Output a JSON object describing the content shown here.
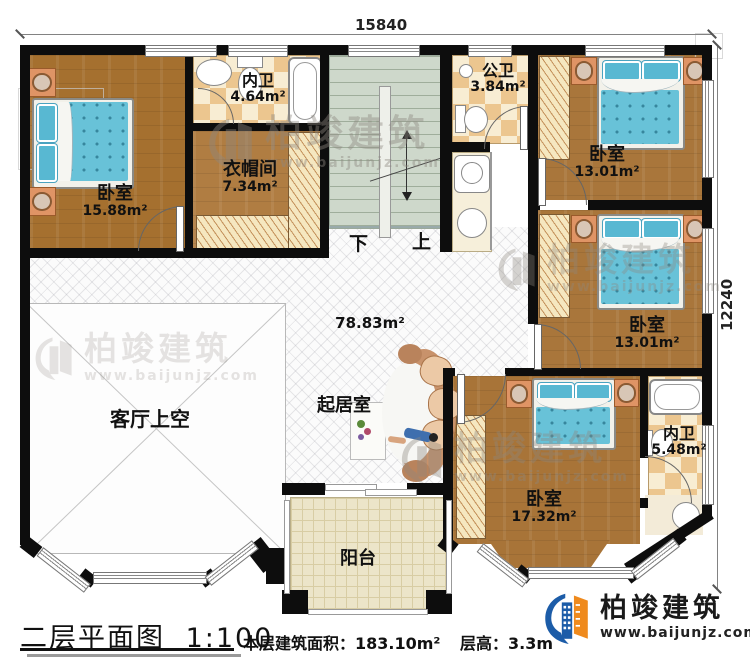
{
  "title": {
    "text": "二层平面图",
    "scale": "1:100"
  },
  "footer": {
    "area_label": "本层建筑面积：",
    "area_value": "183.10m²",
    "height_label": "层高：",
    "height_value": "3.3m"
  },
  "dimensions": {
    "top": "15840",
    "right": "12240"
  },
  "stairs": {
    "down": "下",
    "up": "上"
  },
  "brand": {
    "name": "柏竣建筑",
    "url": "www.baijunjz.com"
  },
  "rooms": [
    {
      "id": "bedroom-top-left",
      "name": "卧室",
      "area": "15.88m²"
    },
    {
      "id": "ensuite-bath-top",
      "name": "内卫",
      "area": "4.64m²"
    },
    {
      "id": "cloakroom",
      "name": "衣帽间",
      "area": "7.34m²"
    },
    {
      "id": "public-bath",
      "name": "公卫",
      "area": "3.84m²"
    },
    {
      "id": "bedroom-top-right",
      "name": "卧室",
      "area": "13.01m²"
    },
    {
      "id": "bedroom-mid-right",
      "name": "卧室",
      "area": "13.01m²"
    },
    {
      "id": "bedroom-bottom",
      "name": "卧室",
      "area": "17.32m²"
    },
    {
      "id": "ensuite-bath-bottom",
      "name": "内卫",
      "area": "5.48m²"
    },
    {
      "id": "sitting-hall",
      "name": "起居室",
      "area": "78.83m²"
    },
    {
      "id": "living-void",
      "name": "客厅上空",
      "area": ""
    },
    {
      "id": "balcony",
      "name": "阳台",
      "area": ""
    }
  ],
  "colors": {
    "wall": "#0d0d0d",
    "wood_floor": "#a9763b",
    "bed_blue": "#68c2d8",
    "bath_checker": "#ecc68f",
    "stair_green": "#ced8cb",
    "balcony_floor": "#ece5c9",
    "brand_blue": "#1c5ca8",
    "brand_orange": "#ef8a1d"
  }
}
